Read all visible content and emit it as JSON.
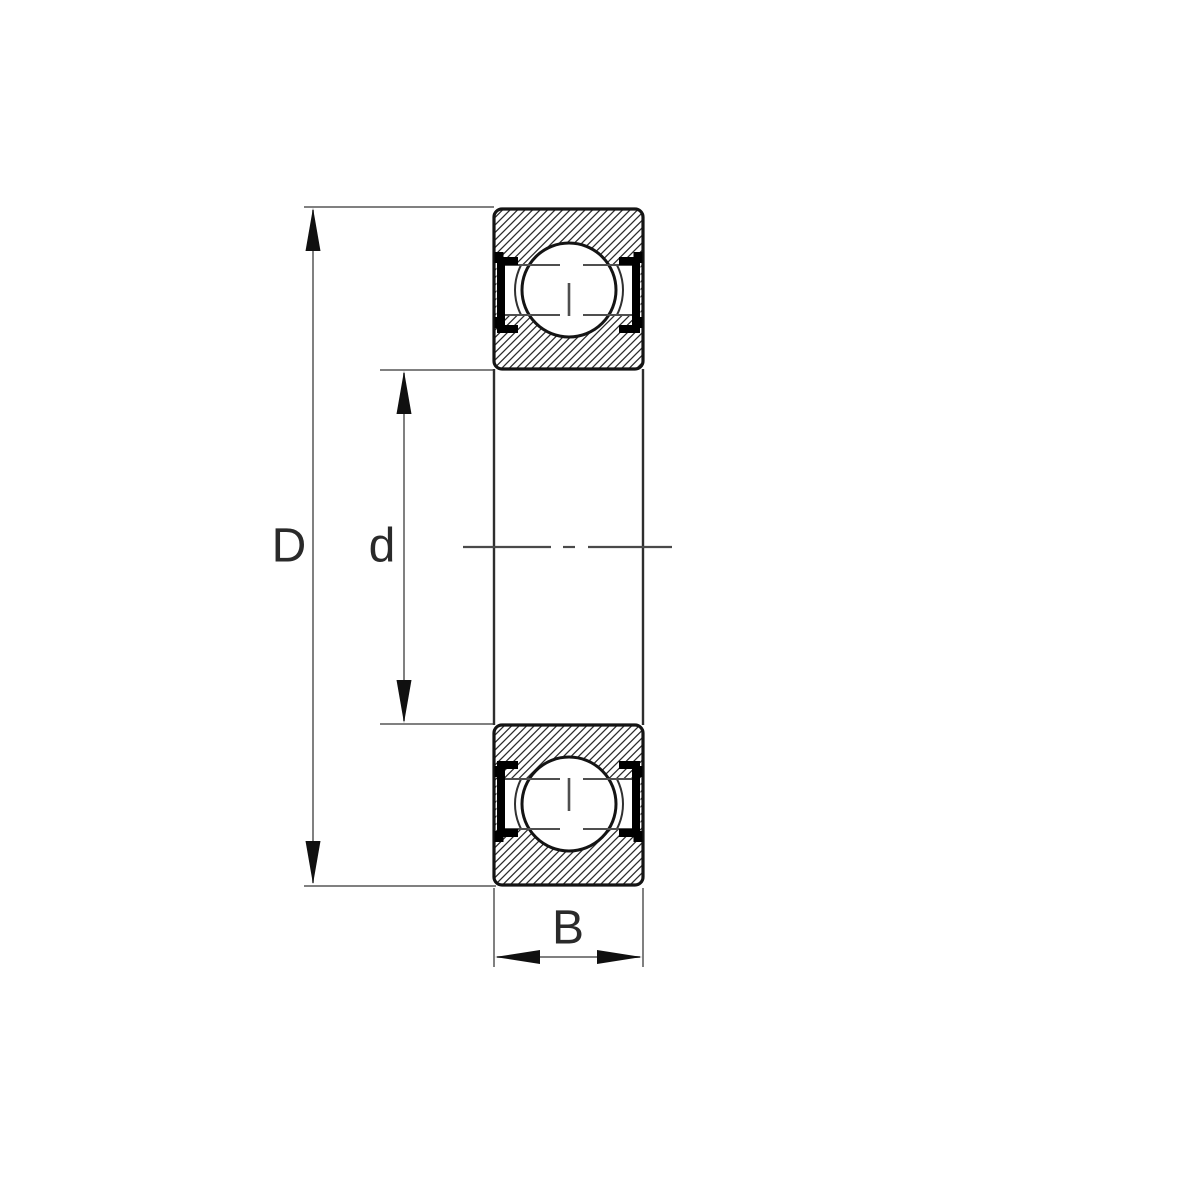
{
  "labels": {
    "outer_diameter": "D",
    "bore_diameter": "d",
    "width": "B"
  },
  "colors": {
    "background": "#ffffff",
    "outline": "#141414",
    "hatch": "#2b2b2b",
    "dimension_line": "#808080",
    "bore_line": "#2e2e2e",
    "centerline": "#4a4a4a",
    "shoulder_line": "#4f4f4f",
    "cage": "#303030",
    "seal": "#000000",
    "arrow": "#101010",
    "label_text": "#2a2a2a"
  }
}
